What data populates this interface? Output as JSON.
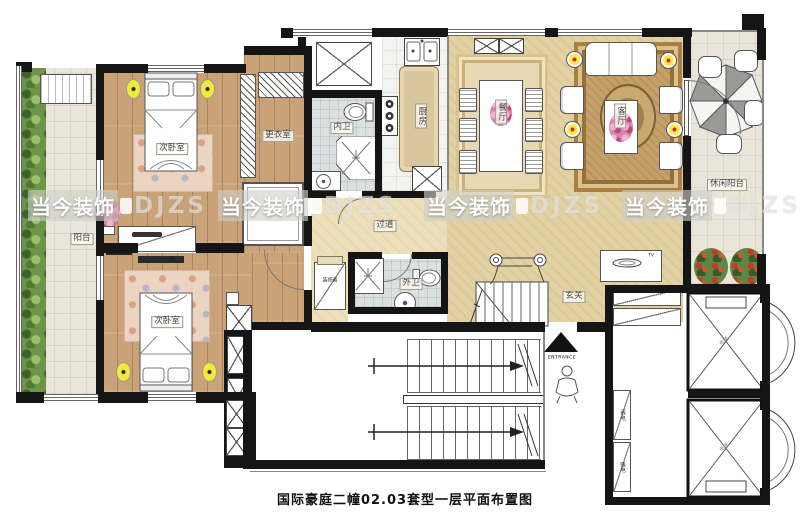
{
  "title": "国际豪庭二幢02.03套型一层平面布置图",
  "watermark": {
    "text": "当今装饰",
    "suffix": "DJZS"
  },
  "rooms": {
    "bedroom1": "次卧室",
    "bedroom2": "次卧室",
    "dressing_room": "更衣室",
    "inner_bath": "内卫",
    "kitchen": "厨房",
    "dining_room": "餐厅",
    "living_room": "客厅",
    "leisure_balcony": "休闲阳台",
    "balcony": "阳台",
    "corridor": "过道",
    "outer_bath": "外卫",
    "foyer": "玄关"
  },
  "annotations": {
    "entrance": "ENTRANCE",
    "tv": "TV",
    "decor_console": "装饰画",
    "weak_current": "弱电",
    "strong_current": "强电",
    "elevator": "电梯"
  },
  "colors": {
    "wall": "#151515",
    "wood_floor": "#c9a277",
    "warm_floor": "#e2d1a2",
    "tile_floor": "#e9e6d9",
    "bath_tile": "#dbe1e0",
    "lamp_yellow": "#f2ea38",
    "plant_green": "#6d9448",
    "flower_pink": "#d984ae",
    "rug_brown": "#c5a168",
    "watermark_gray": "#cecec8"
  }
}
